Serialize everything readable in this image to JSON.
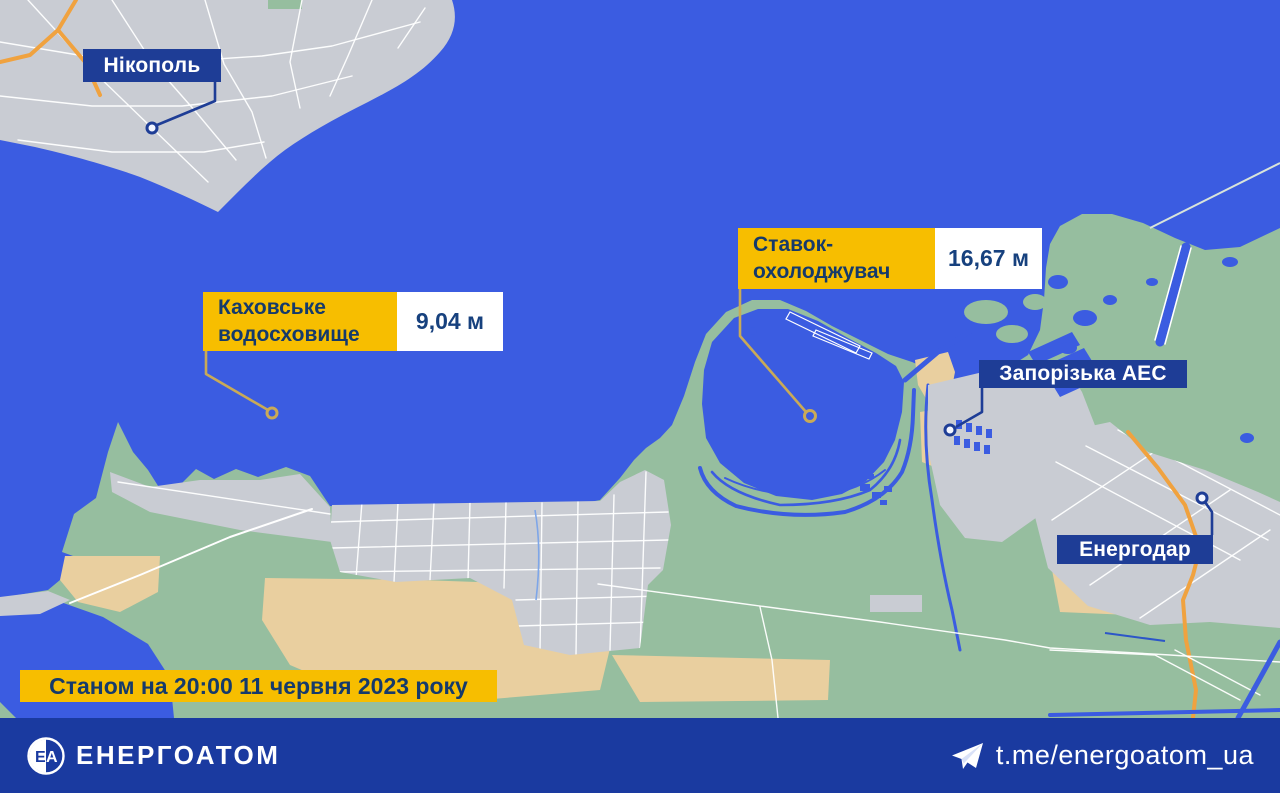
{
  "colors": {
    "water": "#3B5CE1",
    "land-gray": "#C9CCD3",
    "land-green": "#96BE9F",
    "sand": "#E9CF9F",
    "street": "#FFFFFF",
    "road-orange": "#F0A23F",
    "label-navy": "#1E3D96",
    "label-yellow": "#F7BE00",
    "text-navy": "#153A6B",
    "value-navy": "#17417E",
    "footer-bg": "#1A3AA0",
    "pointer-gold": "#C9AA57"
  },
  "labels": {
    "nikopol": {
      "text": "Нікополь"
    },
    "kakhovka": {
      "line1": "Каховське",
      "line2": "водосховище",
      "value": "9,04 м"
    },
    "cooling_pond": {
      "line1": "Ставок-",
      "line2": "охолоджувач",
      "value": "16,67 м"
    },
    "znpp": {
      "text": "Запорізька АЕС"
    },
    "energodar": {
      "text": "Енергодар"
    },
    "timestamp": {
      "text": "Станом на 20:00 11 червня 2023 року"
    }
  },
  "footer": {
    "brand": "ЕНЕРГОАТОМ",
    "telegram_handle": "t.me/energoatom_ua"
  }
}
